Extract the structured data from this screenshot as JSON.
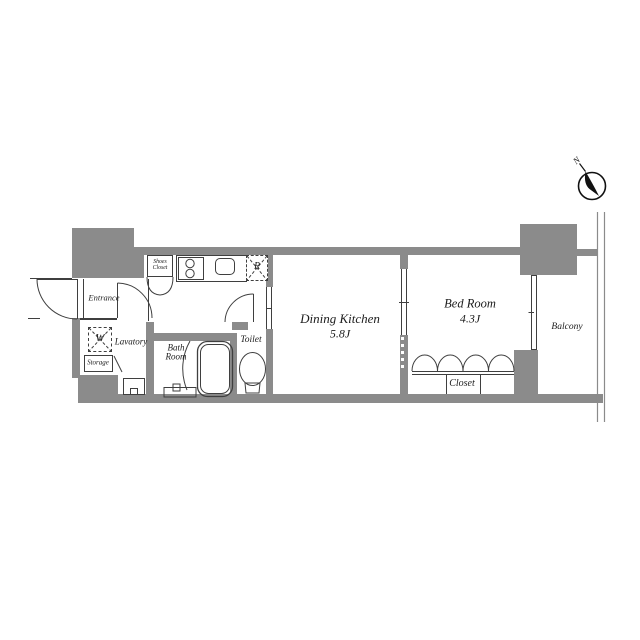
{
  "colors": {
    "wall": "#8b8b8b",
    "line": "#3f3f3f",
    "text": "#1c1c1c"
  },
  "compass": {
    "label": "N"
  },
  "rooms": {
    "entrance": {
      "label": "Entrance"
    },
    "lavatory": {
      "label": "Lavatory"
    },
    "washer": {
      "label": "W"
    },
    "storage": {
      "label": "Storage"
    },
    "bath_room": {
      "line1": "Bath",
      "line2": "Room"
    },
    "toilet": {
      "label": "Toilet"
    },
    "shoes_closet": {
      "line1": "Shoes",
      "line2": "Closet"
    },
    "refrigerator": {
      "label": "R"
    },
    "dining_kitchen": {
      "label": "Dining Kitchen",
      "size": "5.8J"
    },
    "bed_room": {
      "label": "Bed Room",
      "size": "4.3J"
    },
    "closet": {
      "label": "Closet"
    },
    "balcony": {
      "label": "Balcony"
    }
  }
}
